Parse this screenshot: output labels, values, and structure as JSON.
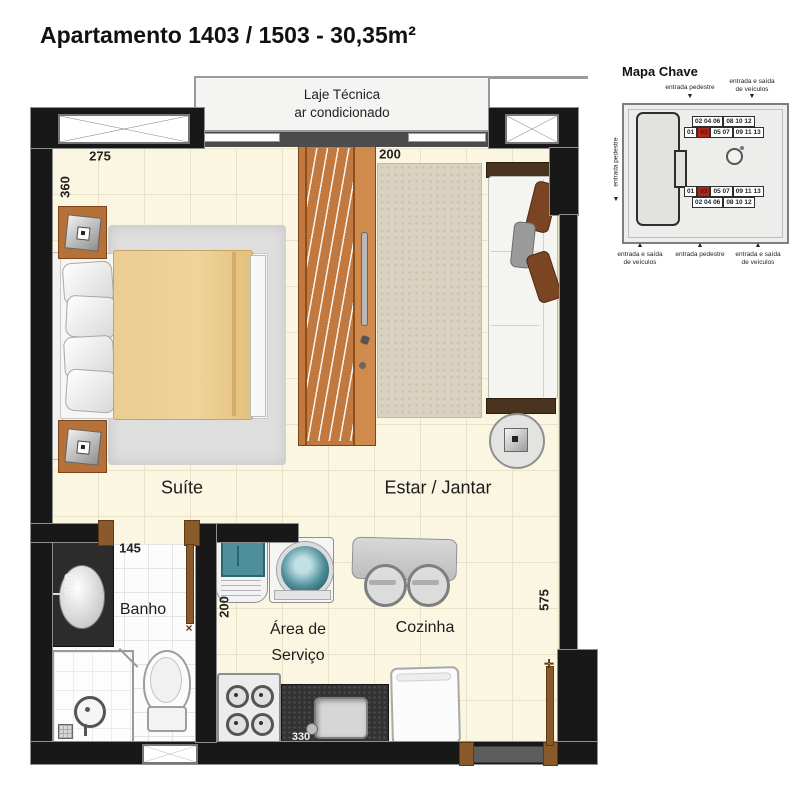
{
  "title": "Apartamento  1403 / 1503 - 30,35m²",
  "plan": {
    "laje": {
      "line1": "Laje Técnica",
      "line2": "ar condicionado"
    },
    "rooms": {
      "suite": "Suíte",
      "estar": "Estar / Jantar",
      "banho": "Banho",
      "servico_line1": "Área de",
      "servico_line2": "Serviço",
      "cozinha": "Cozinha"
    },
    "dimensions": {
      "suite_width": "275",
      "suite_height": "360",
      "estar_width": "200",
      "banho_width": "145",
      "banho_height": "200",
      "servico_height": "200",
      "right_height": "575",
      "counter_width": "330"
    }
  },
  "mapa": {
    "title": "Mapa Chave",
    "labels": {
      "pedestre": "entrada pedestre",
      "veiculos_l1": "entrada e saída",
      "veiculos_l2": "de veículos",
      "arrow_down": "▼",
      "arrow_up": "▲"
    },
    "units": {
      "top_r1a": "02 04 06",
      "top_r1b": "08 10 12",
      "top_r2a": "01",
      "top_r2b": "03",
      "top_r2c": "05 07",
      "top_r2d": "09 11 13",
      "bot_r1a": "01",
      "bot_r1b": "03",
      "bot_r1c": "05 07",
      "bot_r1d": "09 11 13",
      "bot_r2a": "02 04 06",
      "bot_r2b": "08 10 12"
    }
  }
}
